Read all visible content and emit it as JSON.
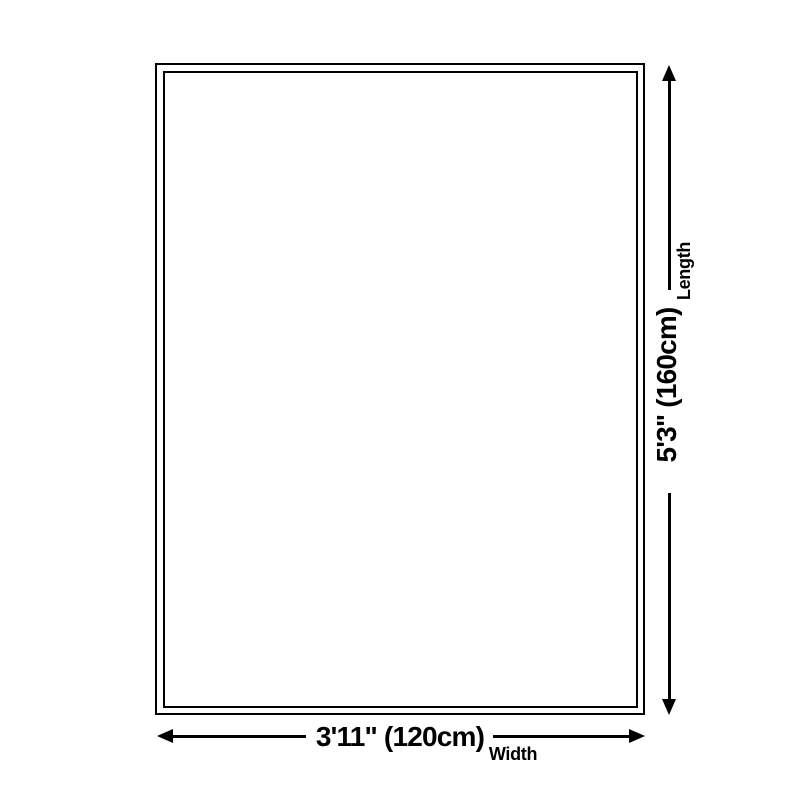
{
  "diagram": {
    "background_color": "#ffffff",
    "ink_color": "#000000",
    "length": {
      "value": "5'3\" (160cm)",
      "label": "Length"
    },
    "width": {
      "value": "3'11\" (120cm)",
      "label": "Width"
    }
  }
}
